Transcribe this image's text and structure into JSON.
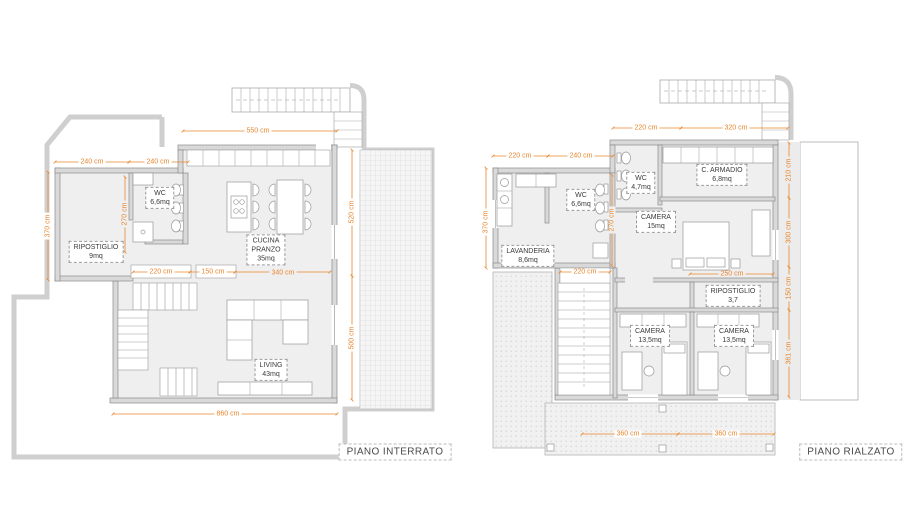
{
  "plans": {
    "left": {
      "title": "PIANO INTERRATO",
      "rooms": {
        "ripostiglio": {
          "name": "RIPOSTIGLIO",
          "area": "9mq"
        },
        "wc": {
          "name": "WC",
          "area": "6,6mq"
        },
        "cucina": {
          "name": "CUCINA\nPRANZO",
          "area": "35mq"
        },
        "living": {
          "name": "LIVING",
          "area": "43mq"
        }
      },
      "dims": {
        "top_width": "550 cm",
        "annex_left": "240 cm",
        "annex_right": "240 cm",
        "annex_height": "370 cm",
        "wc_height": "270 cm",
        "terrace_upper": "520 cm",
        "hall_a": "220 cm",
        "hall_b": "150 cm",
        "hall_c": "340 cm",
        "terrace_lower": "500 cm",
        "total_width": "860 cm"
      }
    },
    "right": {
      "title": "PIANO RIALZATO",
      "rooms": {
        "lavanderia": {
          "name": "LAVANDERIA",
          "area": "8,6mq"
        },
        "wc_small": {
          "name": "WC",
          "area": "6,6mq"
        },
        "wc_top": {
          "name": "WC",
          "area": "4,7mq"
        },
        "armadio": {
          "name": "C. ARMADIO",
          "area": "6,8mq"
        },
        "camera_main": {
          "name": "CAMERA",
          "area": "15mq"
        },
        "ripostiglio": {
          "name": "RIPOSTIGLIO",
          "area": "3,7"
        },
        "camera_left": {
          "name": "CAMERA",
          "area": "13,5mq"
        },
        "camera_right": {
          "name": "CAMERA",
          "area": "13,5mq"
        }
      },
      "dims": {
        "top_a": "220 cm",
        "top_b": "320 cm",
        "block_a": "220 cm",
        "block_b": "240 cm",
        "block_height": "370 cm",
        "wall_height": "270 cm",
        "right_a": "210 cm",
        "right_b": "300 cm",
        "right_c": "150 cm",
        "right_d": "361 cm",
        "stair_width": "220 cm",
        "rip_width": "250 cm",
        "cam_a": "360 cm",
        "cam_b": "360 cm"
      }
    }
  },
  "colors": {
    "dimension_orange": "#E8862D",
    "wall_fill": "#D9D9D9",
    "wall_stroke": "#8A8A8A",
    "floor_fill": "#EFEFEF",
    "label_text": "#3A3A3A"
  }
}
